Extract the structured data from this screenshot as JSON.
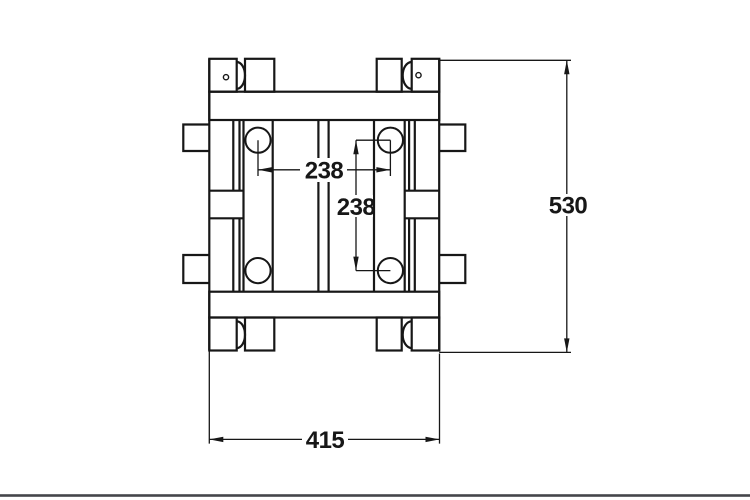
{
  "colors": {
    "line": "#171717",
    "background": "#ffffff",
    "footer_rule": "#44464a"
  },
  "dimensions": {
    "horizontal_span": "238",
    "vertical_span": "238",
    "overall_height": "530",
    "overall_width": "415"
  }
}
